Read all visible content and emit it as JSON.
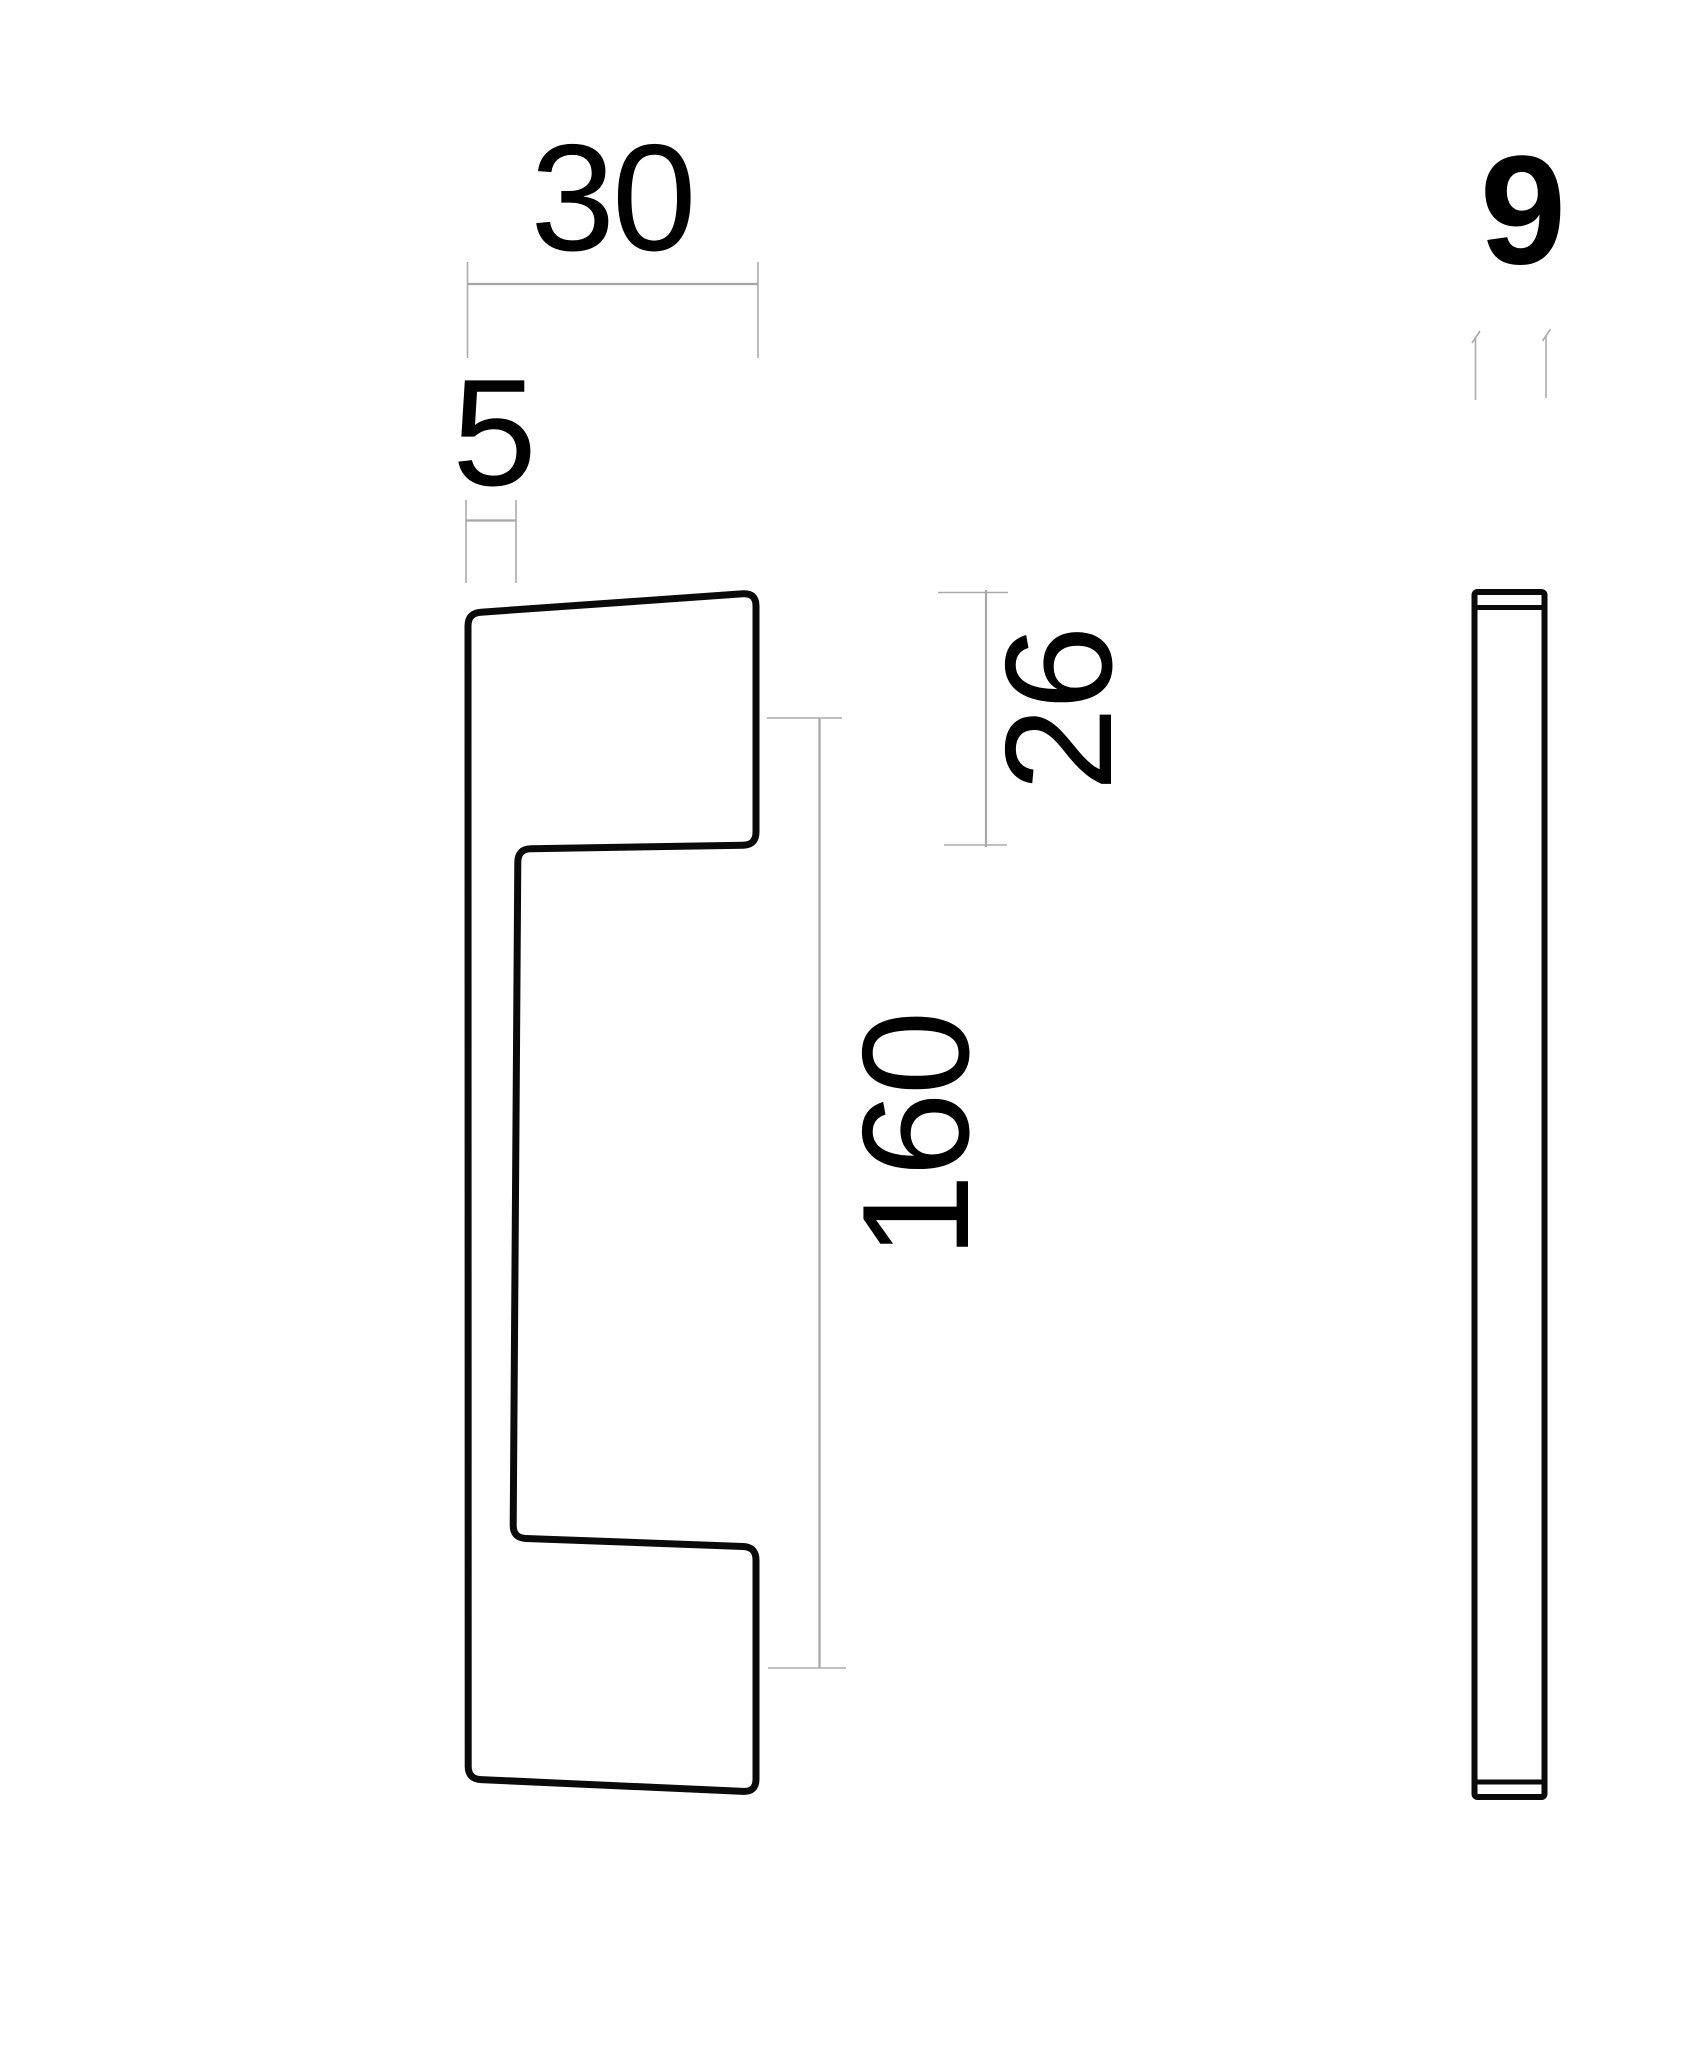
{
  "drawing": {
    "kind": "technical-dimension-drawing",
    "subject": "pull handle shown in side profile view and edge view",
    "colors": {
      "background": "#ffffff",
      "outline": "#0a0a0a",
      "dimension_lines": "#a6a6a6",
      "labels": "#000000"
    },
    "side_view": {
      "name": "side-profile-view",
      "dimensions": {
        "top_width": "30",
        "wall_thickness": "5",
        "projection": "26",
        "length": "160"
      }
    },
    "edge_view": {
      "name": "edge-view",
      "dimensions": {
        "thickness": "9"
      }
    }
  }
}
